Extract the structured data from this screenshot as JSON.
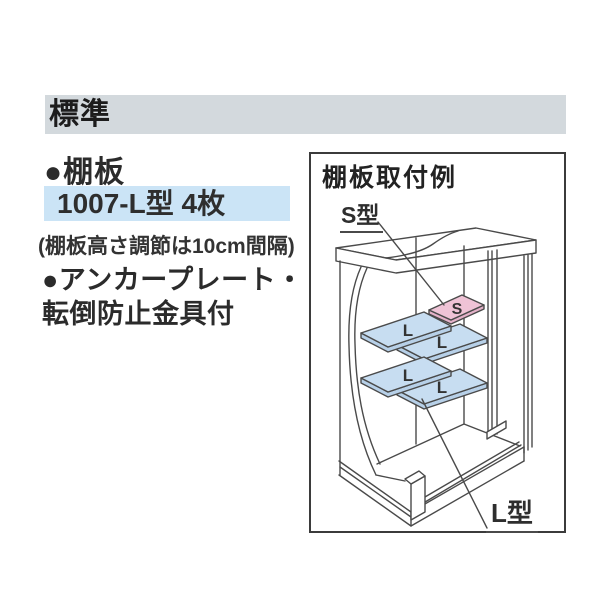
{
  "page": {
    "background": "#ffffff"
  },
  "panel": {
    "header": {
      "label": "標準",
      "bg": "#d3d9dd"
    },
    "shelf_bullet": "●棚板",
    "shelf_spec": {
      "label": "1007-L型 4枚",
      "bg": "#cbe4f6"
    },
    "shelf_note": "(棚板高さ調節は10cm間隔)",
    "anchor_bullet_line1": "●アンカープレート・",
    "anchor_bullet_line2": "転倒防止金具付"
  },
  "diagram": {
    "title": "棚板取付例",
    "s_type_label": "S型",
    "l_type_label": "L型",
    "shelf_s_letter": "S",
    "shelf_l_letter": "L",
    "colors": {
      "shelf_blue": "#c7ddf1",
      "shelf_blue_edge": "#b7d0e8",
      "shelf_pink": "#efc3d6",
      "shelf_pink_edge": "#e4b2c9",
      "line": "#4a4a4a"
    }
  }
}
